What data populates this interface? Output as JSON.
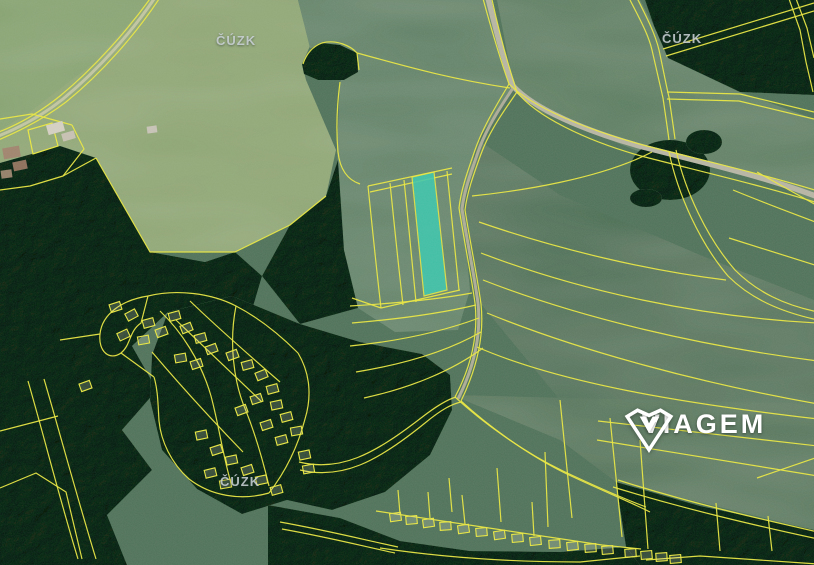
{
  "logo": {
    "text": "VIAGEM",
    "icon": "viagem-diamond-v-icon"
  },
  "watermarks": {
    "top_left": "ČÚZK",
    "top_right": "ČÚZK",
    "bottom": "ČÚZK"
  },
  "colors": {
    "base": "#50725a",
    "field_light": "#8ca46f",
    "field_corner": "#83a06c",
    "field_central": "#5c7f63",
    "field_right_top": "#567a5d",
    "field_right_main": "#4c6e54",
    "field_right_lower": "#507257",
    "forest": "#31563c",
    "road_main": "#b9b6a6",
    "road_lane": "#aeac98",
    "road_farm": "#c4c7a2",
    "line_yellow": "#ece93f",
    "highlight": "#3bc8af",
    "building_fill": "rgba(234,228,200,0.22)",
    "watermark": "#cdd3d8",
    "logo_white": "#ffffff"
  },
  "highlight_parcel": {
    "points": "412,177 434,172 447,290 424,296",
    "fill": "#3bc8af"
  },
  "map_layers": {
    "fields": [
      {
        "name": "field-light-topleft",
        "points": "0,0 298,0 310,46 302,64 306,80 336,150 326,196 290,225 235,252 150,252 96,158 60,146 0,163",
        "fill": "#8ca46f"
      },
      {
        "name": "field-topleft-corner",
        "points": "0,0 150,0 95,62 30,112 0,130",
        "fill": "#83a06c"
      },
      {
        "name": "field-central",
        "points": "298,0 487,0 497,38 512,88 478,140 462,205 470,290 458,330 395,332 358,308 344,250 337,150 340,82 357,53 310,48",
        "fill": "#5c7f63"
      },
      {
        "name": "field-right-top",
        "points": "497,0 640,0 654,26 668,58 740,92 814,119 814,203 763,174 640,152 540,112 514,88",
        "fill": "#567a5d"
      },
      {
        "name": "field-right-main",
        "points": "478,140 560,195 700,255 814,300 814,440 620,450 560,400 481,304 465,210",
        "fill": "#4c6e54"
      },
      {
        "name": "field-right-lower",
        "points": "452,395 560,440 616,482 814,530 814,404",
        "fill": "#507257"
      }
    ],
    "clearings": [
      {
        "cx": 72,
        "cy": 375,
        "rx": 30,
        "ry": 22,
        "fill": "#66875f"
      },
      {
        "cx": 30,
        "cy": 330,
        "rx": 22,
        "ry": 28,
        "fill": "#5d7f5a"
      }
    ],
    "forests": [
      {
        "points": "0,163 60,146 96,158 150,252 205,262 235,252 262,276 252,310 206,330 168,312 132,346 157,390 122,430 152,470 107,515 127,565 0,565"
      },
      {
        "points": "290,225 326,196 338,160 344,250 358,308 300,324 262,276"
      },
      {
        "points": "168,312 232,296 300,324 360,342 422,354 450,375 452,410 430,455 385,492 332,510 287,500 242,514 197,489 162,450 150,400 152,355"
      },
      {
        "points": "645,0 814,0 814,95 740,92 668,58 654,26"
      },
      {
        "points": "268,505 340,518 400,541 470,551 560,552 626,547 641,565 268,565"
      },
      {
        "points": "616,482 700,506 814,530 814,565 640,565 626,547"
      },
      {
        "points": "302,64 312,48 322,43 340,45 357,53 358,72 344,80 318,80 304,74"
      }
    ],
    "forest_clumps": [
      {
        "cx": 670,
        "cy": 170,
        "rx": 40,
        "ry": 30
      },
      {
        "cx": 704,
        "cy": 142,
        "rx": 18,
        "ry": 12
      },
      {
        "cx": 646,
        "cy": 198,
        "rx": 16,
        "ry": 9
      }
    ],
    "roads": [
      {
        "name": "road-main",
        "d": "M487,-6 C496,30 503,58 513,86 C534,109 585,131 643,147 C705,163 763,176 818,197",
        "stroke": "#b9b6a6",
        "w": 5.5
      },
      {
        "name": "road-lane-branch",
        "d": "M513,88 C499,109 486,129 478,152 C470,175 464,192 462,209 C468,246 474,274 478,303 C481,331 476,363 458,399",
        "stroke": "#aeac98",
        "w": 3
      },
      {
        "name": "road-farm-lane",
        "d": "M156,-4 C133,31 98,70 63,99 C43,115 19,128 -4,137",
        "stroke": "#c4c7a2",
        "w": 3
      }
    ],
    "lines": [
      "M152,-4 C128,30 94,68 60,96 C40,112 18,125 -4,133",
      "M161,-4 C137,33 102,73 66,102 C45,118 20,131 -4,141",
      "M0,119 L32,114 L72,125",
      "M72,125 L84,149 L63,176 L30,186 L0,190",
      "M63,176 L96,158",
      "M96,158 L150,252 L235,252 L290,225 L326,196",
      "M303,64 C307,52 314,46 322,43 C336,39 351,46 357,53 L359,70",
      "M357,53 C398,64 444,78 510,88",
      "M340,82 C337,105 336,130 338,152 C340,170 348,180 360,184",
      "M368,186 L452,168",
      "M370,192 L452,174",
      "M368,186 C372,225 376,265 381,308",
      "M390,183 C394,222 398,262 403,305",
      "M404,180 C408,220 412,258 416,302",
      "M447,171 C451,210 455,250 459,290",
      "M381,308 L460,290",
      "M352,298 L381,308",
      "M350,306 C400,303 440,299 472,293",
      "M352,323 C400,319 442,313 476,305",
      "M350,346 C400,341 444,331 479,318",
      "M356,372 C405,364 448,351 481,332",
      "M364,398 C410,388 452,371 483,348",
      "M482,-5 C491,28 499,56 509,84 C532,107 585,129 643,145 C705,161 763,174 818,191",
      "M491,-5 C499,32 507,62 517,92 C536,116 584,140 641,156 C703,172 760,185 818,203",
      "M509,84 C496,106 483,127 475,150 C467,173 461,190 459,208 C465,246 471,274 475,303 C478,331 473,363 455,397",
      "M517,92 C503,112 489,132 481,154 C473,176 467,193 465,210 C471,247 477,275 481,304 C484,332 479,364 461,401",
      "M628,-4 C638,16 648,33 652,50 C656,68 660,85 663,98 C665,112 667,125 669,140",
      "M636,-4 C646,16 655,33 659,50 C663,68 666,85 669,97 C671,111 673,124 675,139",
      "M669,152 C678,195 700,243 728,276 C751,299 781,312 818,320",
      "M676,150 C685,191 707,238 735,270 C757,292 784,305 818,312",
      "M663,49 L814,3",
      "M666,56 L814,11",
      "M667,92 L740,94 L814,112",
      "M667,99 L739,101 L814,119",
      "M788,-4 L800,30 L806,62 L813,92",
      "M795,-4 L807,28 L814,58",
      "M472,196 C520,191 600,179 652,152",
      "M479,222 C560,250 650,271 726,280",
      "M481,253 C580,291 700,317 818,323",
      "M483,280 C580,318 700,346 818,361",
      "M487,313 C580,351 700,383 818,404",
      "M477,347 C560,383 680,403 818,419",
      "M733,190 C772,206 800,216 818,223",
      "M757,172 L818,206",
      "M729,238 L818,266",
      "M598,421 L818,446",
      "M597,440 L818,476",
      "M757,478 L818,457",
      "M716,503 L720,551",
      "M768,516 L772,551",
      "M618,480 C690,503 760,519 818,532",
      "M613,487 C688,510 758,526 818,539",
      "M455,397 C480,420 521,451 563,471 C599,488 622,498 646,507",
      "M461,401 C486,424 527,455 569,475 C603,491 628,501 650,512",
      "M299,462 C340,472 373,455 421,418 C439,404 449,399 456,397",
      "M300,470 C342,480 377,462 425,423 C442,409 452,404 461,402",
      "M376,511 C440,521 520,533 602,545 L641,549",
      "M380,548 C440,557 510,562 580,562 L640,556",
      "M280,522 C330,531 365,540 398,547",
      "M282,529 C332,538 362,546 395,553",
      "M646,560 L700,556 L818,564",
      "M449,478 L452,512",
      "M497,468 L501,522",
      "M545,452 L548,527",
      "M560,400 L572,518",
      "M610,418 L622,537",
      "M640,440 L648,549",
      "M398,490 L400,514",
      "M428,492 L430,518",
      "M462,495 L465,524",
      "M532,502 L534,536",
      "M28,381 C45,440 60,500 78,559",
      "M44,379 C61,437 77,497 96,559",
      "M0,431 L58,416",
      "M0,488 L36,473 L66,492 L82,559",
      "M148,296 C122,300 102,314 100,334 C98,352 110,361 121,353 C131,345 129,331 141,323 L148,296",
      "M148,296 C176,289 211,293 236,306 C261,319 281,336 298,353",
      "M298,353 C310,373 312,396 305,419 C298,446 286,471 269,493",
      "M269,493 C241,501 211,496 189,479 C171,463 161,441 159,421 C158,405 158,390 154,377",
      "M160,311 C181,331 201,361 211,396 C219,426 223,456 231,483",
      "M236,306 C229,341 233,381 246,411 C256,436 263,461 269,486",
      "M176,320 C205,348 235,376 262,402",
      "M152,352 C180,385 212,420 243,452",
      "M190,301 C218,328 250,356 280,382",
      "M100,334 L60,340",
      "M154,377 L121,353"
    ],
    "farm_outline": "28,130 52,123 58,146 33,154",
    "farm_buildings": [
      [
        47,
        123,
        17,
        10,
        -16,
        "#d7d1c5"
      ],
      [
        62,
        132,
        13,
        8,
        -16,
        "#c9c2b4"
      ],
      [
        147,
        126,
        10,
        7,
        -8,
        "#c9c4b8"
      ],
      [
        3,
        147,
        17,
        11,
        -10,
        "#a2846e"
      ],
      [
        13,
        161,
        14,
        9,
        -12,
        "#8f6f5a"
      ],
      [
        1,
        170,
        11,
        8,
        -8,
        "#96806a"
      ]
    ],
    "buildings_village_main": [
      [
        110,
        303,
        -18
      ],
      [
        126,
        311,
        -28
      ],
      [
        143,
        319,
        -15
      ],
      [
        118,
        331,
        -25
      ],
      [
        138,
        336,
        -10
      ],
      [
        156,
        328,
        -20
      ],
      [
        169,
        312,
        -15
      ],
      [
        181,
        324,
        -22
      ],
      [
        195,
        334,
        -15
      ],
      [
        206,
        345,
        -20
      ],
      [
        175,
        354,
        -10
      ],
      [
        191,
        360,
        -18
      ],
      [
        227,
        351,
        -20
      ],
      [
        242,
        361,
        -15
      ],
      [
        256,
        371,
        -22
      ],
      [
        267,
        385,
        -15
      ],
      [
        251,
        395,
        -18
      ],
      [
        271,
        401,
        -12
      ],
      [
        236,
        406,
        -20
      ],
      [
        281,
        413,
        -15
      ],
      [
        261,
        421,
        -18
      ],
      [
        291,
        427,
        -10
      ],
      [
        276,
        436,
        -15
      ],
      [
        196,
        431,
        -12
      ],
      [
        211,
        446,
        -18
      ],
      [
        226,
        456,
        -12
      ],
      [
        242,
        466,
        -18
      ],
      [
        256,
        476,
        -12
      ],
      [
        271,
        486,
        -16
      ],
      [
        220,
        480,
        -10
      ],
      [
        205,
        469,
        -14
      ],
      [
        299,
        451,
        -12
      ],
      [
        303,
        465,
        -10
      ],
      [
        80,
        382,
        -20
      ]
    ],
    "buildings_bottom_row": [
      [
        390,
        513,
        -8
      ],
      [
        406,
        516,
        -5
      ],
      [
        423,
        519,
        -8
      ],
      [
        440,
        522,
        -4
      ],
      [
        458,
        525,
        -8
      ],
      [
        476,
        528,
        -5
      ],
      [
        494,
        531,
        -8
      ],
      [
        512,
        534,
        -5
      ],
      [
        530,
        537,
        -6
      ],
      [
        549,
        540,
        -4
      ],
      [
        567,
        542,
        -6
      ],
      [
        585,
        544,
        -4
      ],
      [
        602,
        546,
        -5
      ],
      [
        625,
        549,
        -4
      ],
      [
        641,
        551,
        -5
      ],
      [
        656,
        553,
        -4
      ],
      [
        670,
        555,
        -5
      ]
    ]
  }
}
